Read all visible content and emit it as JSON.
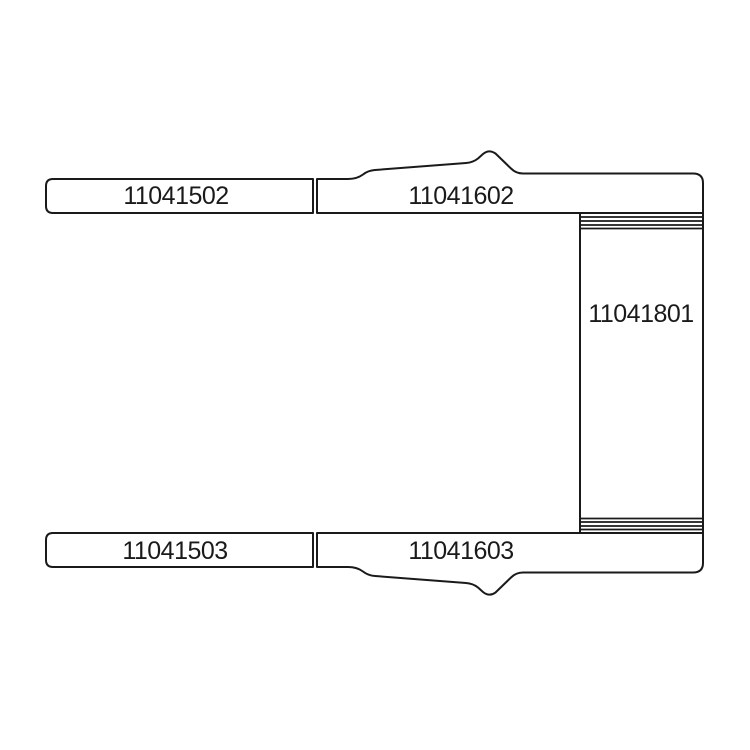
{
  "diagram": {
    "background_color": "#ffffff",
    "line_color": "#1a1a1a",
    "parts": [
      {
        "position": "top-left",
        "label": "11041502"
      },
      {
        "position": "top-right",
        "label": "11041602"
      },
      {
        "position": "side-panel",
        "label": "11041801"
      },
      {
        "position": "bottom-left",
        "label": "11041503"
      },
      {
        "position": "bottom-right",
        "label": "11041603"
      }
    ]
  }
}
